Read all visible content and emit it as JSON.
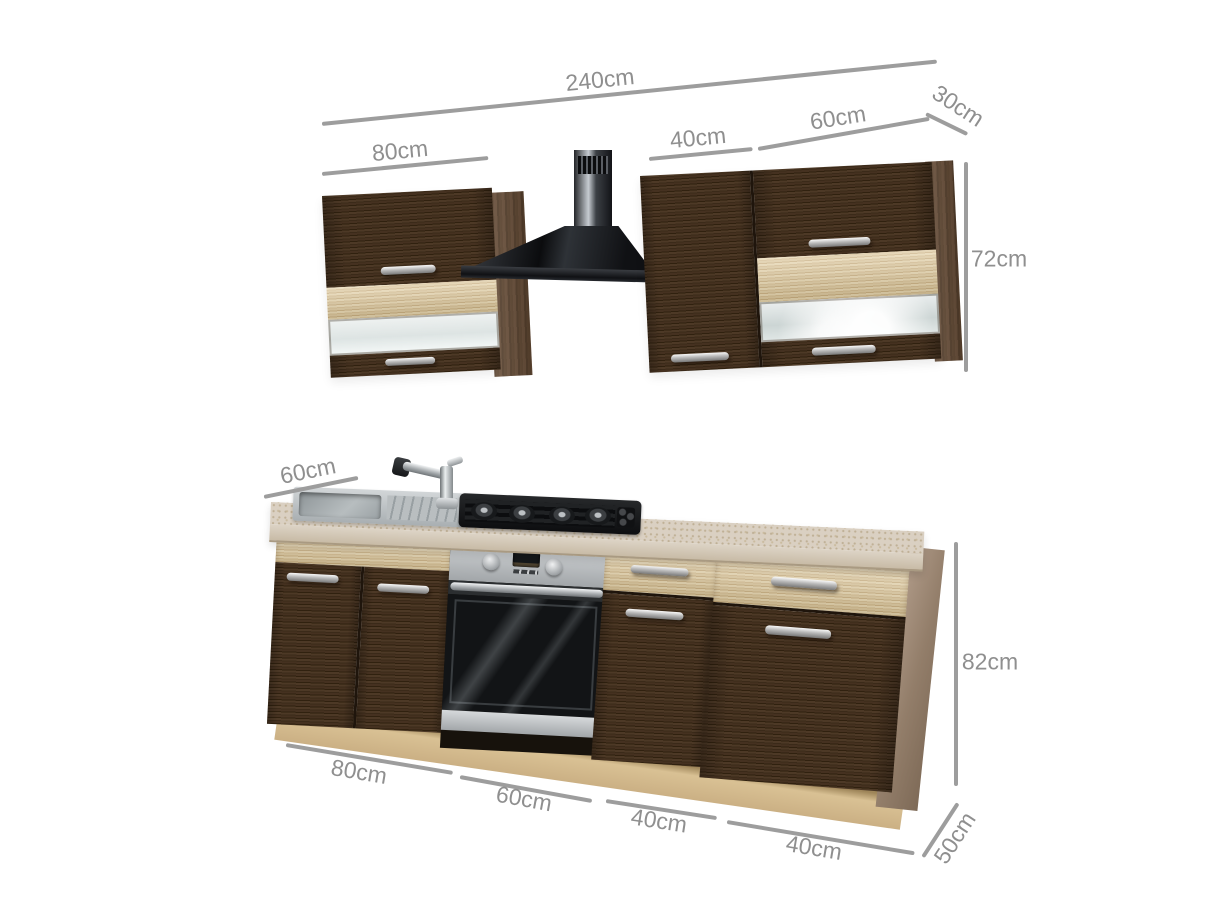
{
  "annotations": {
    "total_width": "240cm",
    "wall_left_width": "80cm",
    "wall_mid_width": "40cm",
    "wall_right_width": "60cm",
    "wall_depth": "30cm",
    "wall_height": "72cm",
    "worktop_depth": "60cm",
    "base_height": "82cm",
    "base_section1_width": "80cm",
    "base_section2_width": "60cm",
    "base_section3_width": "40cm",
    "base_section4_width": "40cm",
    "base_depth": "50cm"
  },
  "palette": {
    "background": "#ffffff",
    "dark_wood": "#42301f",
    "light_oak": "#dcc69c",
    "worktop": "#d8cec0",
    "stainless_steel": "#b9bdc0",
    "hood_black": "#141518",
    "dimension_line": "#9d9d9d",
    "dimension_text": "#8f8f8f"
  }
}
